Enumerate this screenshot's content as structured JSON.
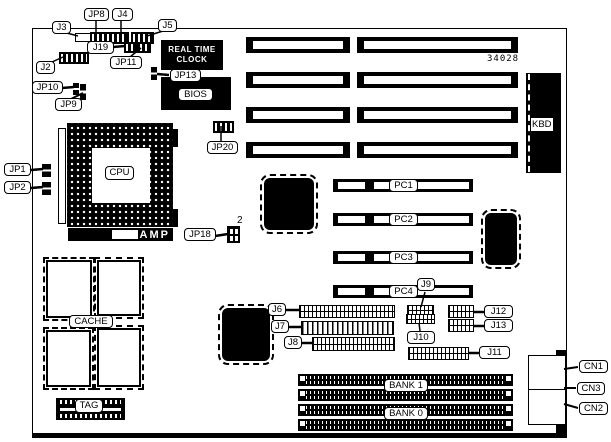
{
  "diagram": {
    "part_number": "34028",
    "colors": {
      "ink": "#000000",
      "paper": "#ffffff"
    }
  },
  "chips": {
    "rtc_line1": "REAL TIME",
    "rtc_line2": "CLOCK",
    "bios": "BIOS",
    "cpu": "CPU",
    "amp": "AMP",
    "kbd": "KBD",
    "cache": "CACHE",
    "tag": "TAG",
    "jp18_pin_count": "2"
  },
  "pci_slots": [
    {
      "id": "pc1",
      "label": "PC1",
      "y": 179
    },
    {
      "id": "pc2",
      "label": "PC2",
      "y": 213
    },
    {
      "id": "pc3",
      "label": "PC3",
      "y": 251
    },
    {
      "id": "pc4",
      "label": "PC4",
      "y": 285
    }
  ],
  "memory_banks": [
    {
      "id": "bank1",
      "label": "BANK 1",
      "label_y": 379
    },
    {
      "id": "bank0",
      "label": "BANK 0",
      "label_y": 407
    }
  ],
  "callouts": [
    {
      "id": "j3",
      "text": "J3",
      "x": 52,
      "y": 21,
      "w": 19
    },
    {
      "id": "jp8",
      "text": "JP8",
      "x": 84,
      "y": 8,
      "w": 25
    },
    {
      "id": "j4",
      "text": "J4",
      "x": 112,
      "y": 8,
      "w": 21
    },
    {
      "id": "j5",
      "text": "J5",
      "x": 158,
      "y": 19,
      "w": 19
    },
    {
      "id": "j19",
      "text": "J19",
      "x": 87,
      "y": 41,
      "w": 27
    },
    {
      "id": "jp11",
      "text": "JP11",
      "x": 110,
      "y": 56,
      "w": 32
    },
    {
      "id": "j2",
      "text": "J2",
      "x": 36,
      "y": 61,
      "w": 19
    },
    {
      "id": "jp10",
      "text": "JP10",
      "x": 32,
      "y": 81,
      "w": 31
    },
    {
      "id": "jp9",
      "text": "JP9",
      "x": 55,
      "y": 98,
      "w": 27
    },
    {
      "id": "jp13",
      "text": "JP13",
      "x": 170,
      "y": 69,
      "w": 31
    },
    {
      "id": "jp20",
      "text": "JP20",
      "x": 207,
      "y": 141,
      "w": 31
    },
    {
      "id": "jp1",
      "text": "JP1",
      "x": 4,
      "y": 163,
      "w": 27
    },
    {
      "id": "jp2",
      "text": "JP2",
      "x": 4,
      "y": 181,
      "w": 27
    },
    {
      "id": "jp18",
      "text": "JP18",
      "x": 184,
      "y": 228,
      "w": 32
    },
    {
      "id": "j6",
      "text": "J6",
      "x": 268,
      "y": 303,
      "w": 18
    },
    {
      "id": "j7",
      "text": "J7",
      "x": 271,
      "y": 320,
      "w": 18
    },
    {
      "id": "j8",
      "text": "J8",
      "x": 284,
      "y": 336,
      "w": 18
    },
    {
      "id": "j9",
      "text": "J9",
      "x": 417,
      "y": 278,
      "w": 18
    },
    {
      "id": "j10",
      "text": "J10",
      "x": 407,
      "y": 331,
      "w": 28
    },
    {
      "id": "j11",
      "text": "J11",
      "x": 479,
      "y": 346,
      "w": 31
    },
    {
      "id": "j12",
      "text": "J12",
      "x": 484,
      "y": 305,
      "w": 29
    },
    {
      "id": "j13",
      "text": "J13",
      "x": 484,
      "y": 319,
      "w": 29
    },
    {
      "id": "cn1",
      "text": "CN1",
      "x": 579,
      "y": 360,
      "w": 29
    },
    {
      "id": "cn3",
      "text": "CN3",
      "x": 577,
      "y": 382,
      "w": 28
    },
    {
      "id": "cn2",
      "text": "CN2",
      "x": 579,
      "y": 402,
      "w": 29
    }
  ],
  "pointer_lines": [
    [
      96,
      20,
      96,
      32,
      1.5
    ],
    [
      121,
      20,
      121,
      32,
      1.5
    ],
    [
      63,
      32,
      78,
      36,
      1.5
    ],
    [
      163,
      31,
      147,
      36,
      1.5
    ],
    [
      113,
      47,
      125,
      46,
      2.5
    ],
    [
      130,
      57,
      141,
      48,
      1.5
    ],
    [
      52,
      62,
      63,
      57,
      1.5
    ],
    [
      62,
      88,
      74,
      87,
      2.5
    ],
    [
      71,
      99,
      83,
      93,
      2
    ],
    [
      169,
      75,
      157,
      74,
      2.5
    ],
    [
      221,
      141,
      221,
      126,
      1.5
    ],
    [
      31,
      170,
      43,
      169,
      2.5
    ],
    [
      31,
      188,
      43,
      187,
      2.5
    ],
    [
      215,
      236,
      228,
      234,
      2.5
    ],
    [
      286,
      310,
      300,
      310,
      2.5
    ],
    [
      288,
      327,
      302,
      327,
      2.5
    ],
    [
      302,
      343,
      313,
      343,
      2.5
    ],
    [
      425,
      292,
      421,
      307,
      1.5
    ],
    [
      420,
      331,
      419,
      323,
      1.5
    ],
    [
      479,
      353,
      468,
      353,
      2.5
    ],
    [
      484,
      312,
      473,
      312,
      2.5
    ],
    [
      484,
      326,
      473,
      326,
      2.5
    ],
    [
      578,
      367,
      564,
      369,
      2
    ],
    [
      576,
      388,
      564,
      388,
      2
    ],
    [
      578,
      408,
      564,
      404,
      2
    ]
  ]
}
